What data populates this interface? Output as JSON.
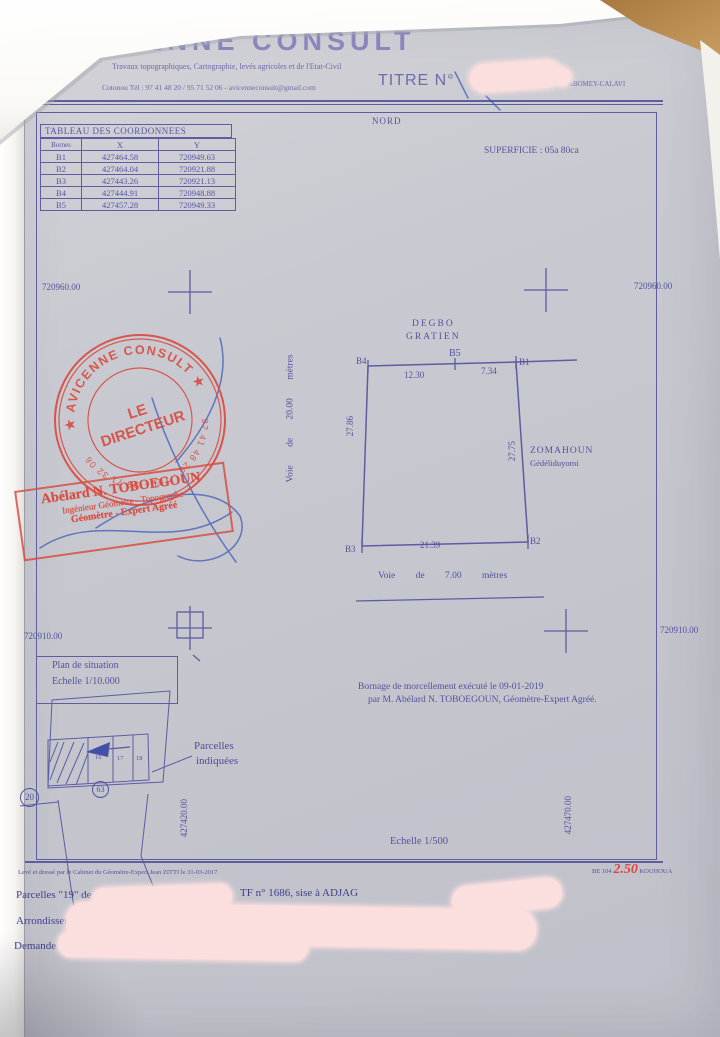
{
  "colors": {
    "ink": "#52529c",
    "stamp_red": "#d84d42",
    "paper": "#c9cad1",
    "redaction_pink": "#fbdfde",
    "pen_blue": "#3a53b6"
  },
  "header": {
    "company": "AVICENNE CONSULT",
    "subtitle": "Travaux topographiques, Cartographie, levés agricoles et de l'Etat-Civil",
    "contact": "Cotonou Tél : 97 41 48 20 / 95 71 52 06 - avicenneconsult@gmail.com",
    "titre_label": "TITRE N°",
    "titre_suffix": "d'ABOMEY-CALAVI"
  },
  "coord_table": {
    "title": "TABLEAU DES COORDONNEES",
    "col_borne": "Bornes",
    "col_x": "X",
    "col_y": "Y",
    "rows": [
      {
        "b": "B1",
        "x": "427464.58",
        "y": "720949.63"
      },
      {
        "b": "B2",
        "x": "427464.04",
        "y": "720921.88"
      },
      {
        "b": "B3",
        "x": "427443.26",
        "y": "720921.13"
      },
      {
        "b": "B4",
        "x": "427444.91",
        "y": "720948.88"
      },
      {
        "b": "B5",
        "x": "427457.28",
        "y": "720949.33"
      }
    ]
  },
  "map": {
    "nord": "NORD",
    "superficie": "SUPERFICIE : 05a 80ca",
    "grid": {
      "y_top_left": "720960.00",
      "y_top_right": "720960.00",
      "y_mid_left": "720910.00",
      "y_mid_right": "720910.00",
      "x_bottom_left": "427420.00",
      "x_bottom_right": "427470.00"
    }
  },
  "plot": {
    "b1": "B1",
    "b2": "B2",
    "b3": "B3",
    "b4": "B4",
    "b5": "B5",
    "d_top_left": "12.30",
    "d_top_right": "7.34",
    "d_left": "27.86",
    "d_right": "27.75",
    "d_bottom": "21.39",
    "neighbor_top_1": "DEGBO",
    "neighbor_top_2": "GRATIEN",
    "neighbor_right_1": "ZOMAHOUN",
    "neighbor_right_2": "Gédéliduyomi",
    "road_left": "Voie de 20.00 mètres",
    "road_bottom": "Voie de 7.00 mètres"
  },
  "stamps": {
    "round_top": "★ AVICENNE CONSULT ★",
    "round_center_1": "LE",
    "round_center_2": "DIRECTEUR",
    "round_bottom": "97 41 48 20 · TEL · 95 71 32 06",
    "rect_line1": "Abélard N. TOBOEGOUN",
    "rect_line2": "Ingénieur Géomètre - Topographe",
    "rect_line3": "Géomètre - Expert Agréé"
  },
  "situation": {
    "title": "Plan de situation",
    "scale": "Echelle 1/10.000",
    "parcelles_1": "Parcelles",
    "parcelles_2": "indiquées",
    "circle_left": "20",
    "circle_mid": "63",
    "cells": [
      "16",
      "17",
      "18"
    ]
  },
  "notes": {
    "bornage_1": "Bornage de morcellement exécuté le 09-01-2019",
    "bornage_2": "par M. Abélard N. TOBOEGOUN, Géomètre-Expert Agréé.",
    "scale_main": "Echelle 1/500"
  },
  "footer": {
    "small_print": "Levé et dressé par le Cabinet du Géomètre-Expert Jean ZITTI le 31-03-2017",
    "ref_prefix": "BE 104",
    "ref_red": "2.50",
    "ref_suffix": "KOUHOUA",
    "line1_a": "Parcelles \"19\" de",
    "line1_b": "TF n° 1686, sise à ADJAG",
    "line2": "Arrondissement",
    "line3": "Demande"
  }
}
